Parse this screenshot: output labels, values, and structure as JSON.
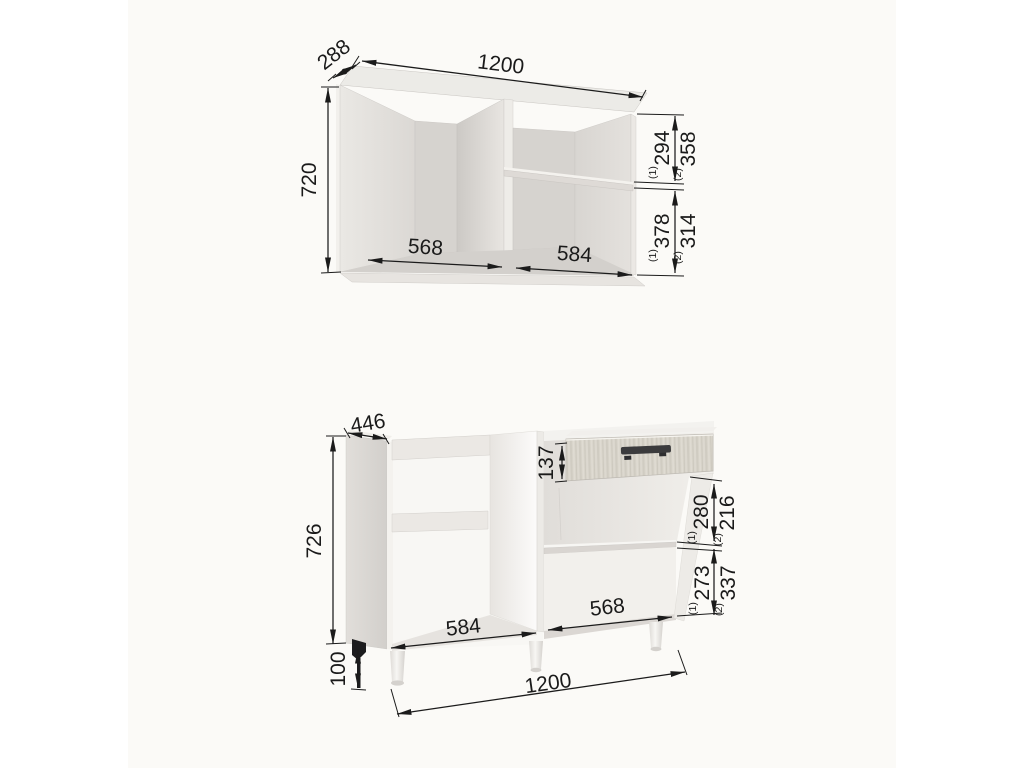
{
  "diagram": {
    "wall_cabinet": {
      "width": "1200",
      "depth": "288",
      "height": "720",
      "left_opening_width": "568",
      "right_opening_width": "584",
      "section_heights": [
        {
          "sup": "(1)",
          "value": "294"
        },
        {
          "sup": "(2)",
          "value": "358"
        },
        {
          "sup": "(1)",
          "value": "378"
        },
        {
          "sup": "(2)",
          "value": "314"
        }
      ]
    },
    "base_cabinet": {
      "width": "1200",
      "depth": "446",
      "height": "726",
      "leg_height": "100",
      "drawer_front_height": "137",
      "left_opening_width": "584",
      "right_opening_width": "568",
      "section_heights": [
        {
          "sup": "(1)",
          "value": "280"
        },
        {
          "sup": "(2)",
          "value": "216"
        },
        {
          "sup": "(1)",
          "value": "273"
        },
        {
          "sup": "(2)",
          "value": "337"
        }
      ]
    },
    "colors": {
      "dimension_lines": "#1b1b1b",
      "paper": "#fbfaf7",
      "cabinet_light": "#eceae6",
      "cabinet_shadow": "#d3d0cc",
      "drawer_wood": "#d7d3c9",
      "handle": "#3b3b3d"
    }
  }
}
